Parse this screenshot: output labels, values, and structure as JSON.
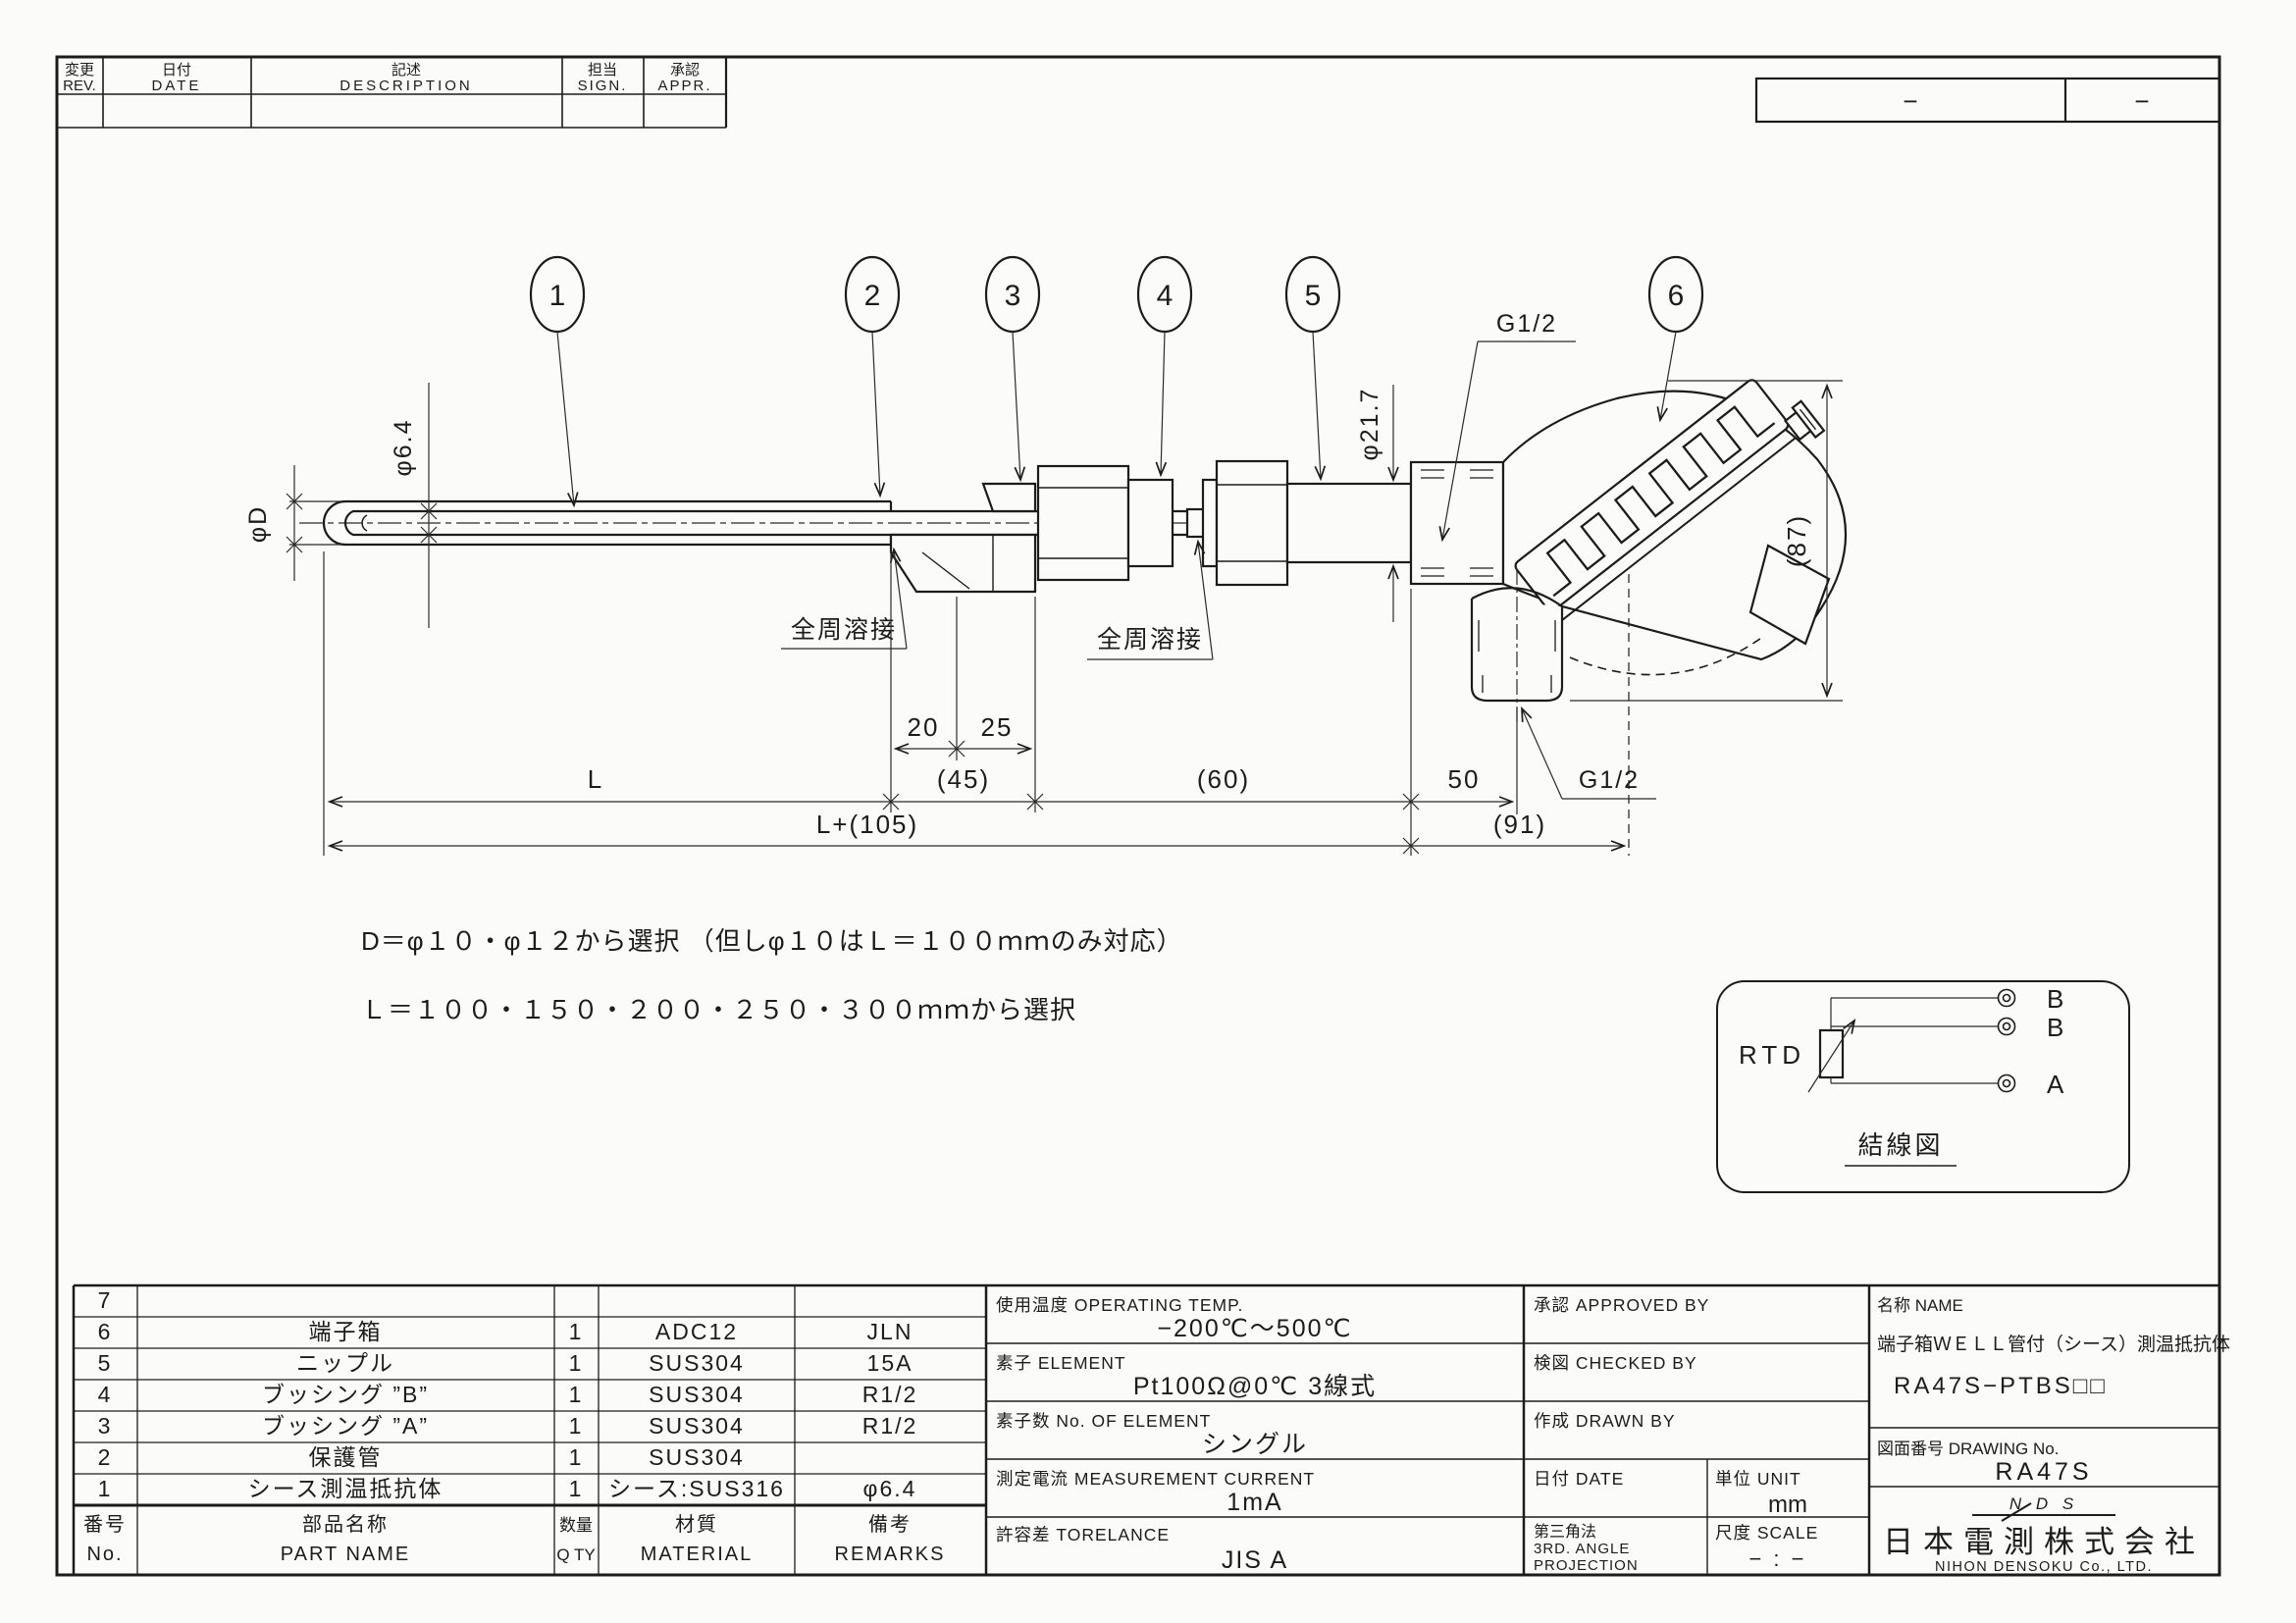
{
  "revision_table": {
    "rev_jp": "変更",
    "rev_en": "REV.",
    "date_jp": "日付",
    "date_en": "DATE",
    "desc_jp": "記述",
    "desc_en": "DESCRIPTION",
    "sign_jp": "担当",
    "sign_en": "SIGN.",
    "appr_jp": "承認",
    "appr_en": "APPR."
  },
  "corner_box": {
    "left_dash": "−",
    "right_dash": "−"
  },
  "balloons": {
    "b1": "1",
    "b2": "2",
    "b3": "3",
    "b4": "4",
    "b5": "5",
    "b6": "6"
  },
  "callouts": {
    "g12_top": "G1/2",
    "g12_bottom": "G1/2",
    "phi217": "φ21.7",
    "phi64": "φ6.4",
    "phiD": "φD",
    "weld_left": "全周溶接",
    "weld_right": "全周溶接"
  },
  "dims": {
    "d20": "20",
    "d25": "25",
    "L": "L",
    "d45": "(45)",
    "d60": "(60)",
    "d50": "50",
    "L105": "L+(105)",
    "d91": "(91)",
    "d87": "(87)"
  },
  "notes": {
    "line1": "D＝φ１０・φ１２から選択 （但しφ１０はＬ＝１００ｍｍのみ対応）",
    "line2": "Ｌ＝１００・１５０・２００・２５０・３００ｍｍから選択"
  },
  "wiring": {
    "label": "RTD",
    "t1": "B",
    "t2": "B",
    "t3": "A",
    "caption": "結線図"
  },
  "parts_table": {
    "header": {
      "no_jp": "番号",
      "no_en": "No.",
      "name_jp": "部品名称",
      "name_en": "PART NAME",
      "qty_jp": "数量",
      "qty_en": "Q TY",
      "mat_jp": "材質",
      "mat_en": "MATERIAL",
      "rem_jp": "備考",
      "rem_en": "REMARKS"
    },
    "rows": [
      {
        "no": "7",
        "name": "",
        "qty": "",
        "mat": "",
        "rem": ""
      },
      {
        "no": "6",
        "name": "端子箱",
        "qty": "1",
        "mat": "ADC12",
        "rem": "JLN"
      },
      {
        "no": "5",
        "name": "ニップル",
        "qty": "1",
        "mat": "SUS304",
        "rem": "15A"
      },
      {
        "no": "4",
        "name": "ブッシング ”B”",
        "qty": "1",
        "mat": "SUS304",
        "rem": "R1/2"
      },
      {
        "no": "3",
        "name": "ブッシング ”A”",
        "qty": "1",
        "mat": "SUS304",
        "rem": "R1/2"
      },
      {
        "no": "2",
        "name": "保護管",
        "qty": "1",
        "mat": "SUS304",
        "rem": ""
      },
      {
        "no": "1",
        "name": "シース測温抵抗体",
        "qty": "1",
        "mat": "シース:SUS316",
        "rem": "φ6.4"
      }
    ]
  },
  "spec_table": {
    "rows": [
      {
        "label": "使用温度 OPERATING TEMP.",
        "value": "−200℃～500℃"
      },
      {
        "label": "素子 ELEMENT",
        "value": "Pt100Ω@0℃ 3線式"
      },
      {
        "label": "素子数 No. OF ELEMENT",
        "value": "シングル"
      },
      {
        "label": "測定電流 MEASUREMENT CURRENT",
        "value": "1mA"
      },
      {
        "label": "許容差 TORELANCE",
        "value": "JIS A"
      }
    ]
  },
  "sign_table": {
    "approved": "承認 APPROVED BY",
    "checked": "検図 CHECKED BY",
    "drawn": "作成 DRAWN BY",
    "date": "日付 DATE",
    "unit_label": "単位 UNIT",
    "unit_value": "mm",
    "projection_jp": "第三角法",
    "projection_en1": "3RD. ANGLE",
    "projection_en2": "PROJECTION",
    "scale_label": "尺度 SCALE",
    "scale_value": "− : −"
  },
  "title_block": {
    "name_label": "名称 NAME",
    "product": "端子箱ＷＥＬＬ管付（シース）測温抵抗体",
    "model": "RA47S−PTBS□□",
    "dwg_label": "図面番号 DRAWING No.",
    "dwg_no": "RA47S",
    "logo": "N D S",
    "company_jp": "日本電測株式会社",
    "company_en": "NIHON DENSOKU Co., LTD."
  }
}
